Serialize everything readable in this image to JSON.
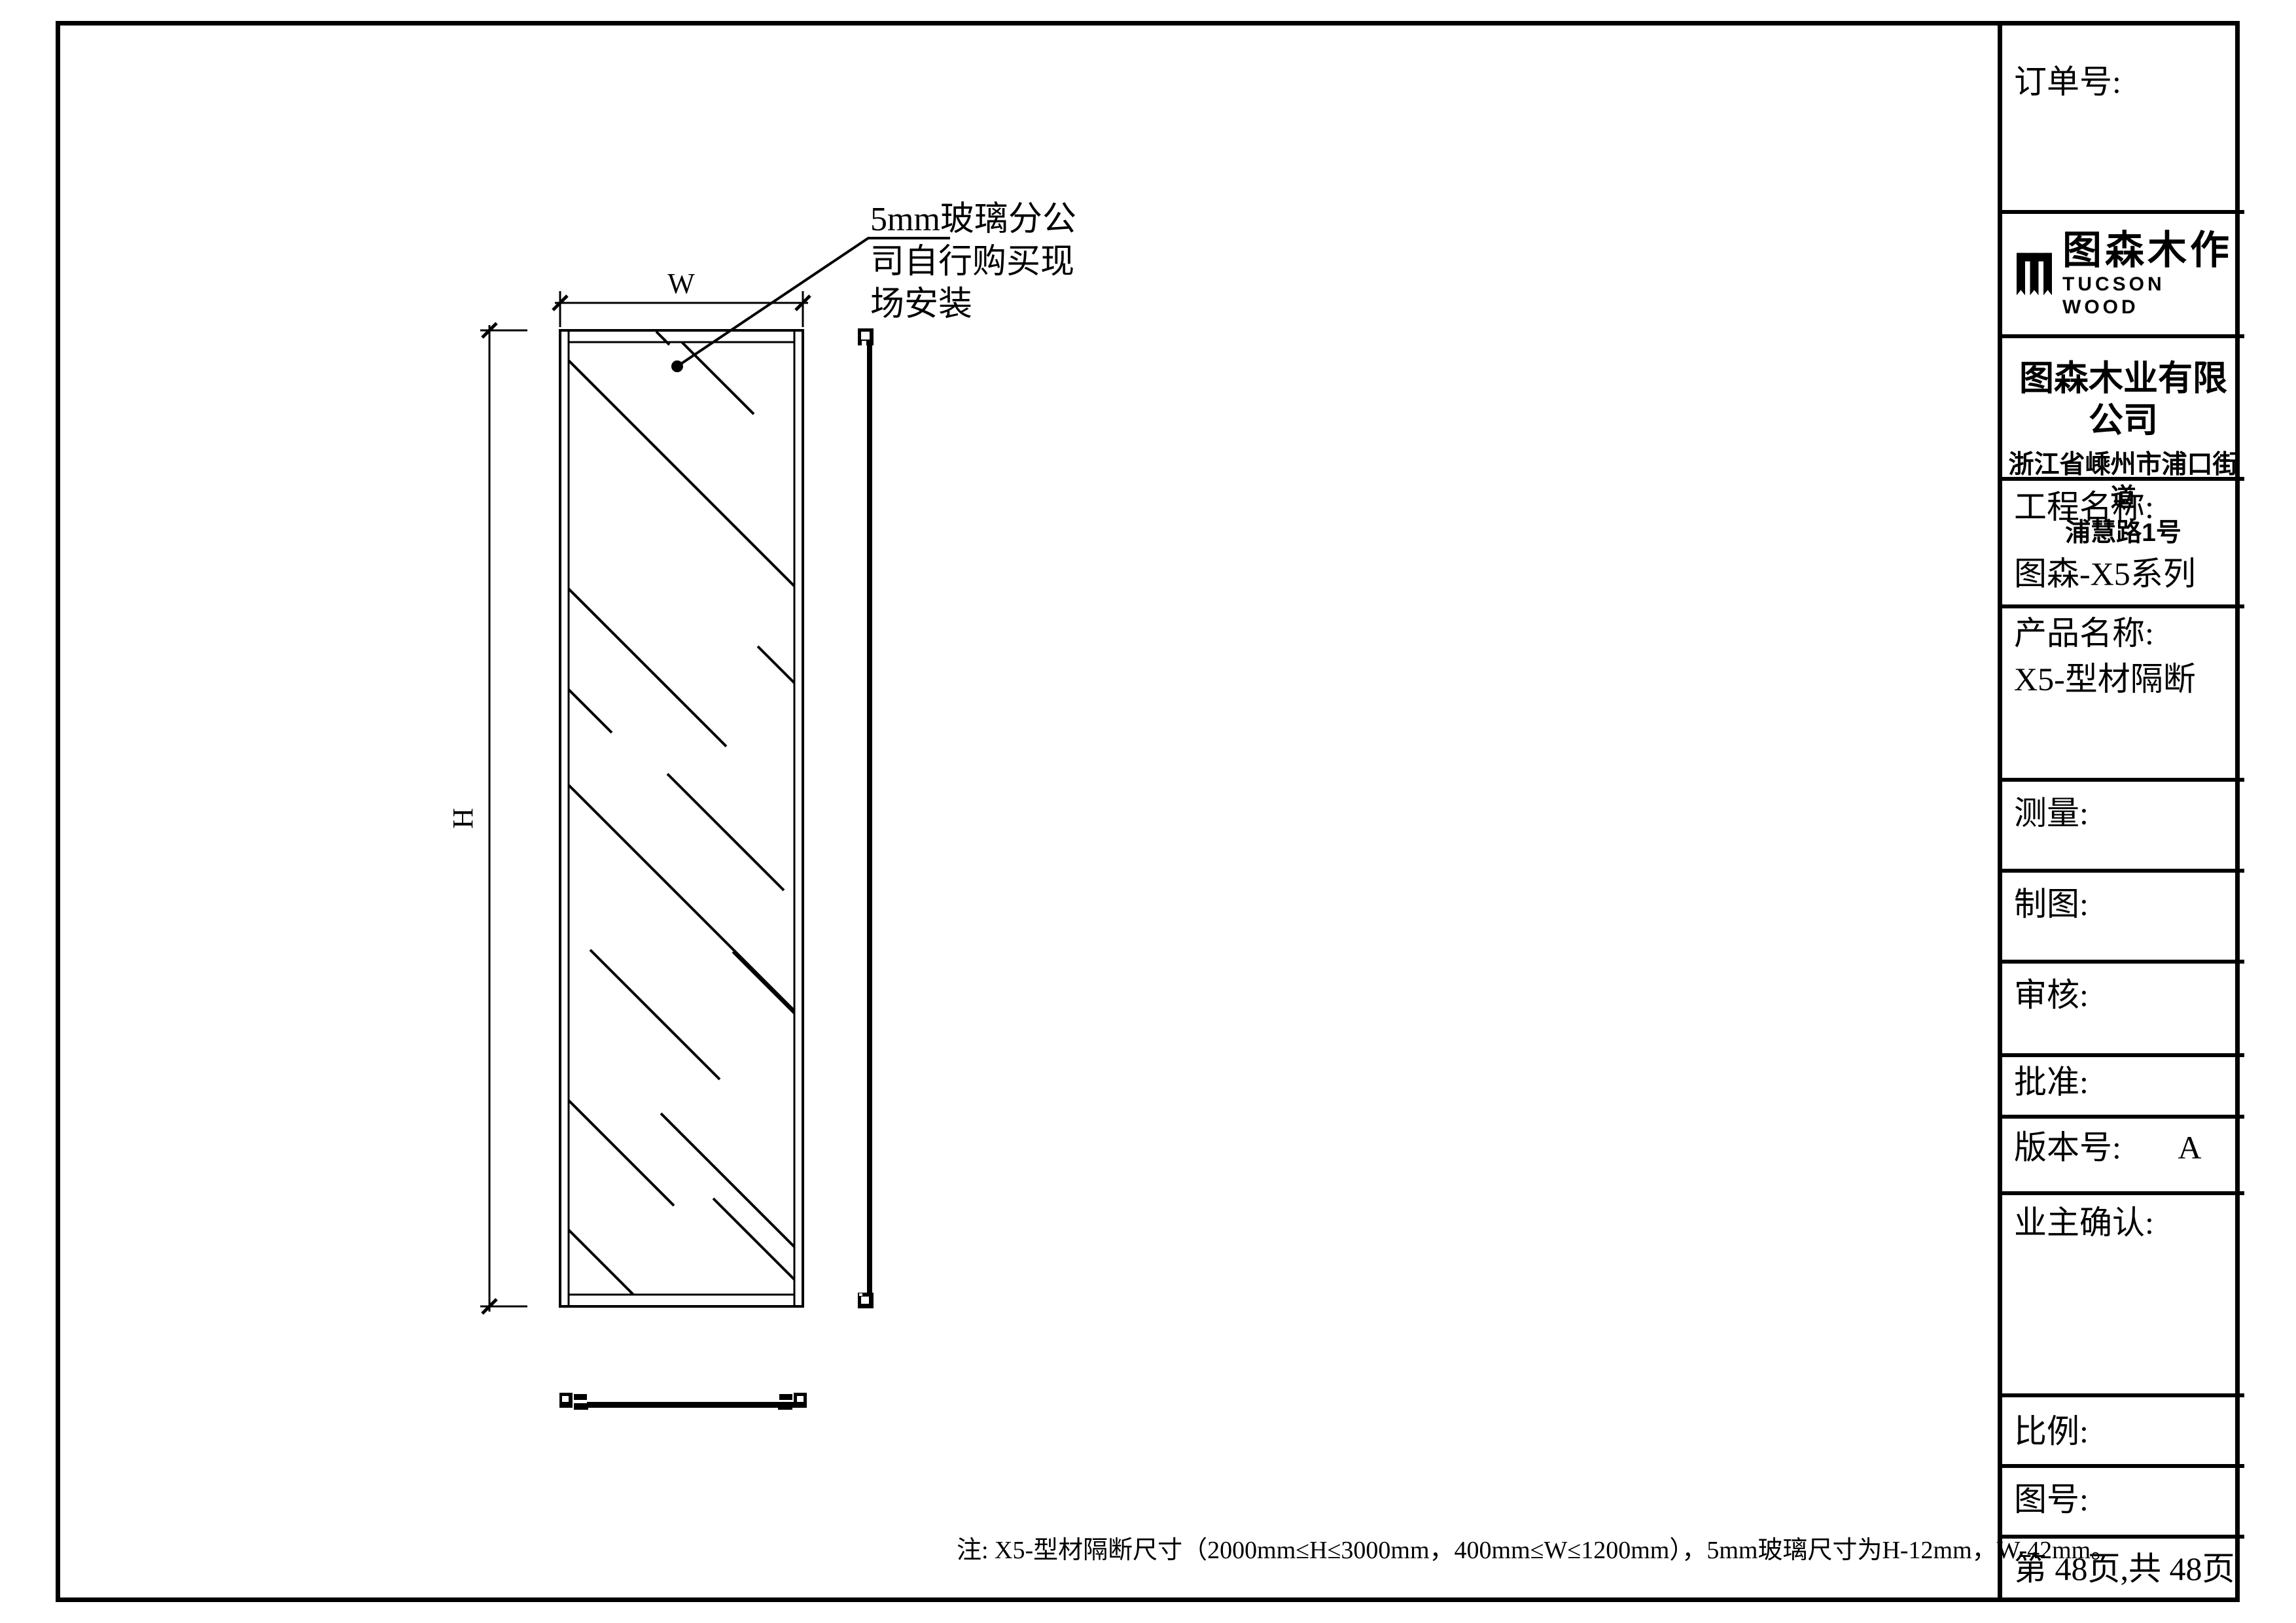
{
  "page": {
    "background": "#ffffff",
    "line_color": "#000000"
  },
  "drawing": {
    "dim_w_label": "W",
    "dim_h_label": "H",
    "annotation": {
      "line1": "5mm玻璃分公",
      "line2": "司自行购买现",
      "line3": "场安装"
    },
    "note": "注: X5-型材隔断尺寸（2000mm≤H≤3000mm，400mm≤W≤1200mm），5mm玻璃尺寸为H-12mm，W-42mm。"
  },
  "titleblock": {
    "order_no_label": "订单号:",
    "logo": {
      "icon": "tucson-wood-logo-icon",
      "cn": "图森木作",
      "en": "TUCSON WOOD"
    },
    "company": {
      "name": "图森木业有限公司",
      "address1": "浙江省嵊州市浦口街道",
      "address2": "浦慧路1号"
    },
    "project_label": "工程名称:",
    "project_value": "图森-X5系列",
    "product_label": "产品名称:",
    "product_value": "X5-型材隔断",
    "measure_label": "测量:",
    "draft_label": "制图:",
    "review_label": "审核:",
    "approve_label": "批准:",
    "version_label": "版本号:",
    "version_value": "A",
    "owner_confirm_label": "业主确认:",
    "scale_label": "比例:",
    "drawing_no_label": "图号:",
    "page_info": "第 48页,共 48页"
  }
}
